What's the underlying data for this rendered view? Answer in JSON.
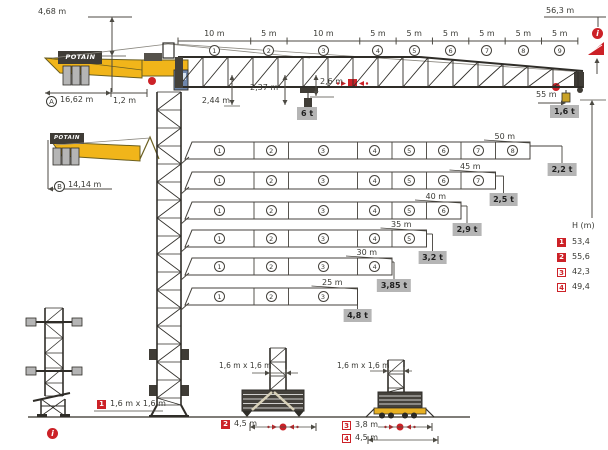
{
  "brand": "POTAIN",
  "colors": {
    "yellow": "#F1B51A",
    "red": "#CC2127",
    "structure": "#2F2D28",
    "box_gray": "#B5B5B5"
  },
  "icons": {
    "info_glyph": "i"
  },
  "dimensions": {
    "counterjib_height": "4,68 m",
    "jib_total": "56,3 m",
    "radius_a_letter": "A",
    "radius_a": "16,62 m",
    "axis_offset": "1,2 m",
    "hook_clearance_1": "2,44 m",
    "hook_clearance_2": "2,37 m",
    "hook_clearance_3": "2,6 m",
    "max_capacity": "6 t",
    "tip_radius": "55 m",
    "tip_capacity": "1,6 t",
    "radius_b_letter": "B",
    "radius_b": "14,14 m"
  },
  "jib_sections": [
    {
      "no": "1",
      "length": "10 m",
      "m": 10
    },
    {
      "no": "2",
      "length": "5 m",
      "m": 5
    },
    {
      "no": "3",
      "length": "10 m",
      "m": 10
    },
    {
      "no": "4",
      "length": "5 m",
      "m": 5
    },
    {
      "no": "5",
      "length": "5 m",
      "m": 5
    },
    {
      "no": "6",
      "length": "5 m",
      "m": 5
    },
    {
      "no": "7",
      "length": "5 m",
      "m": 5
    },
    {
      "no": "8",
      "length": "5 m",
      "m": 5
    },
    {
      "no": "9",
      "length": "5 m",
      "m": 5
    }
  ],
  "configurations": [
    {
      "length": "50 m",
      "m": 50,
      "sections": 8,
      "capacity": "2,2 t"
    },
    {
      "length": "45 m",
      "m": 45,
      "sections": 7,
      "capacity": "2,5 t"
    },
    {
      "length": "40 m",
      "m": 40,
      "sections": 6,
      "capacity": "2,9 t"
    },
    {
      "length": "35 m",
      "m": 35,
      "sections": 5,
      "capacity": "3,2 t"
    },
    {
      "length": "30 m",
      "m": 30,
      "sections": 4,
      "capacity": "3,85 t"
    },
    {
      "length": "25 m",
      "m": 25,
      "sections": 3,
      "capacity": "4,8 t"
    }
  ],
  "height_table": {
    "header": "H (m)",
    "rows": [
      {
        "icon": "1",
        "value": "53,4"
      },
      {
        "icon": "2",
        "value": "55,6"
      },
      {
        "icon": "3",
        "value": "42,3"
      },
      {
        "icon": "4",
        "value": "49,4"
      }
    ]
  },
  "bases": {
    "tower": {
      "icon": "1",
      "mast": "1,6 m x 1,6 m"
    },
    "cross": {
      "mast": "1,6 m x 1,6 m",
      "icon": "2",
      "width": "4,5 m"
    },
    "chassis": {
      "mast": "1,6 m x 1,6 m",
      "rows": [
        {
          "icon": "3",
          "width": "3,8 m"
        },
        {
          "icon": "4",
          "width": "4,5 m"
        }
      ]
    }
  }
}
